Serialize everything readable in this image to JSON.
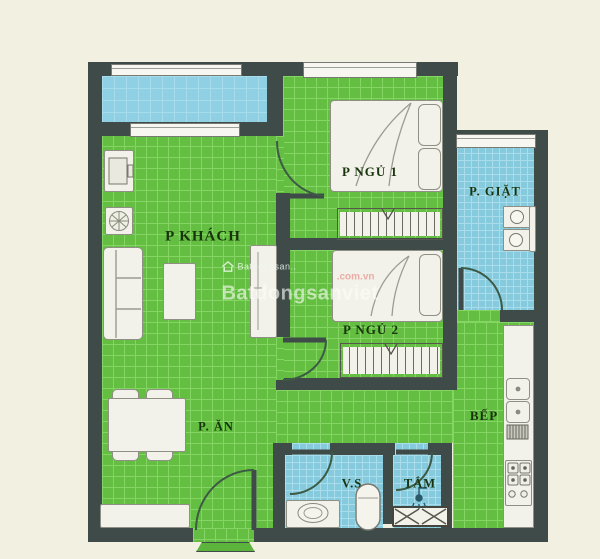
{
  "title": "Apartment floor plan",
  "rooms": {
    "living": {
      "label": "P KHÁCH"
    },
    "bedroom1": {
      "label": "P NGỦ 1"
    },
    "bedroom2": {
      "label": "P NGỦ 2"
    },
    "laundry": {
      "label": "P. GIẶT"
    },
    "kitchen": {
      "label": "BẾP"
    },
    "dining": {
      "label": "P. ĂN"
    },
    "toilet": {
      "label": "V.S"
    },
    "bath": {
      "label": "TẮM"
    }
  },
  "watermark": {
    "brand_small": "Batdongsan..",
    "domain": ".com.vn",
    "brand_large": "Batdongsanviet"
  },
  "colors": {
    "background": "#f1f0e1",
    "wall": "#3e4b49",
    "floor_green": "#63be41",
    "tile_blue": "#85cadd",
    "balcony_blue": "#8fd0e4",
    "furniture": "#f3f2ea",
    "label_text": "#18340d"
  }
}
